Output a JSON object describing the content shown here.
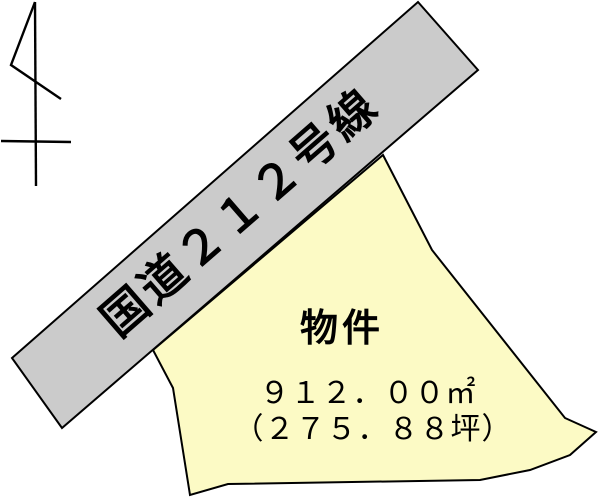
{
  "diagram": {
    "background": "#ffffff",
    "line_color": "#000000"
  },
  "icons": {
    "north_arrow": "north-arrow"
  },
  "road": {
    "label": "国道２１２号線",
    "route_number": "212",
    "fill": "#cbcbcb"
  },
  "parcel": {
    "label": "物件",
    "area_sqm_text": "９１２．００㎡",
    "area_tsubo_text": "（２７５．８８坪）",
    "area_sqm": 912.0,
    "area_tsubo": 275.88,
    "fill": "#fcfac5"
  }
}
